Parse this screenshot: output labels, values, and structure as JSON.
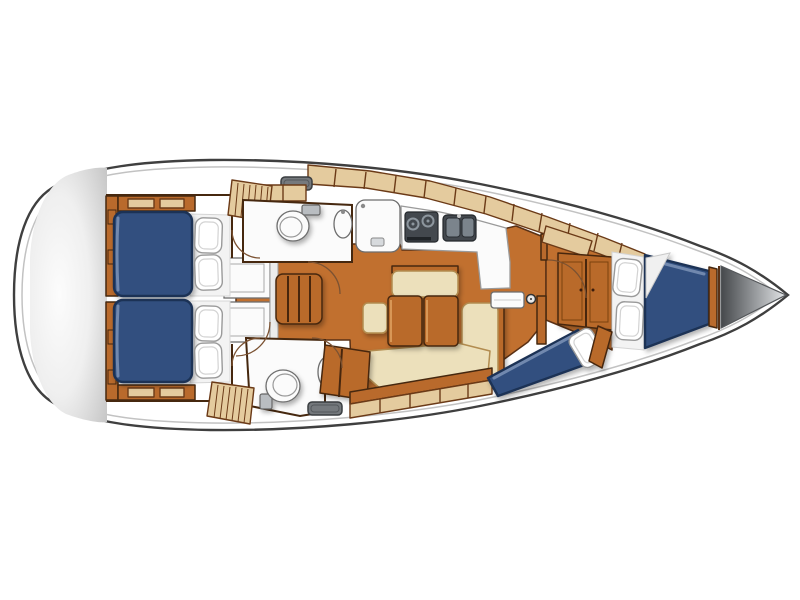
{
  "diagram": {
    "type": "yacht-interior-floor-plan",
    "orientation": "bow-right",
    "rooms": [
      {
        "id": "stern-lazarette",
        "label": "Stern lazarette"
      },
      {
        "id": "aft-cabin-port",
        "label": "Aft port cabin with double berth and pillows"
      },
      {
        "id": "aft-cabin-starboard",
        "label": "Aft starboard cabin with double berth and pillows"
      },
      {
        "id": "companionway",
        "label": "Companionway steps and engine compartment"
      },
      {
        "id": "head-port",
        "label": "Port head with toilet and sink"
      },
      {
        "id": "shower-stall",
        "label": "Separate shower stall"
      },
      {
        "id": "galley",
        "label": "Galley with two-burner stove and double sink"
      },
      {
        "id": "salon",
        "label": "Salon with folding table and U-shaped settee"
      },
      {
        "id": "head-starboard",
        "label": "Starboard head with toilet, sink and deck hatch"
      },
      {
        "id": "nav-cabinet",
        "label": "Angled chart cabinet"
      },
      {
        "id": "forward-cabin",
        "label": "Forward cabin with double berth, dresser and single berth"
      },
      {
        "id": "anchor-locker",
        "label": "Bow anchor locker"
      }
    ],
    "fixtures": [
      "double-berth",
      "pillow",
      "hanging-locker-louvered",
      "deck-hatch",
      "toilet",
      "washbasin",
      "shower-drain",
      "stove-two-burner",
      "double-sink",
      "folding-table",
      "settee-cushion",
      "companionway-steps",
      "engine-box",
      "mast-post",
      "locker-band",
      "dresser",
      "anchor-locker"
    ]
  },
  "colors": {
    "background": "#ffffff",
    "hull_outline": "#3f3f3f",
    "hull_inner_line": "#c2c2c2",
    "wood_floor": "#c1702f",
    "wood_dark": "#5a3115",
    "wood_cabinet": "#b96a2c",
    "locker_tan": "#e4cb9e",
    "locker_divider": "#6b3a17",
    "mattress_navy": "#30507f",
    "mattress_edge": "#1c3154",
    "cushion_cream": "#ece0bb",
    "cushion_edge": "#b28c50",
    "fixture_white": "#fbfbfb",
    "fixture_outline": "#6e6e6e",
    "appliance_dark": "#43484e",
    "appliance_light": "#8d969e",
    "hatch_gray": "#75797d",
    "wall_brown": "#46280f",
    "door_arc": "#7b5232",
    "bedding_white": "#f3f3f3"
  }
}
